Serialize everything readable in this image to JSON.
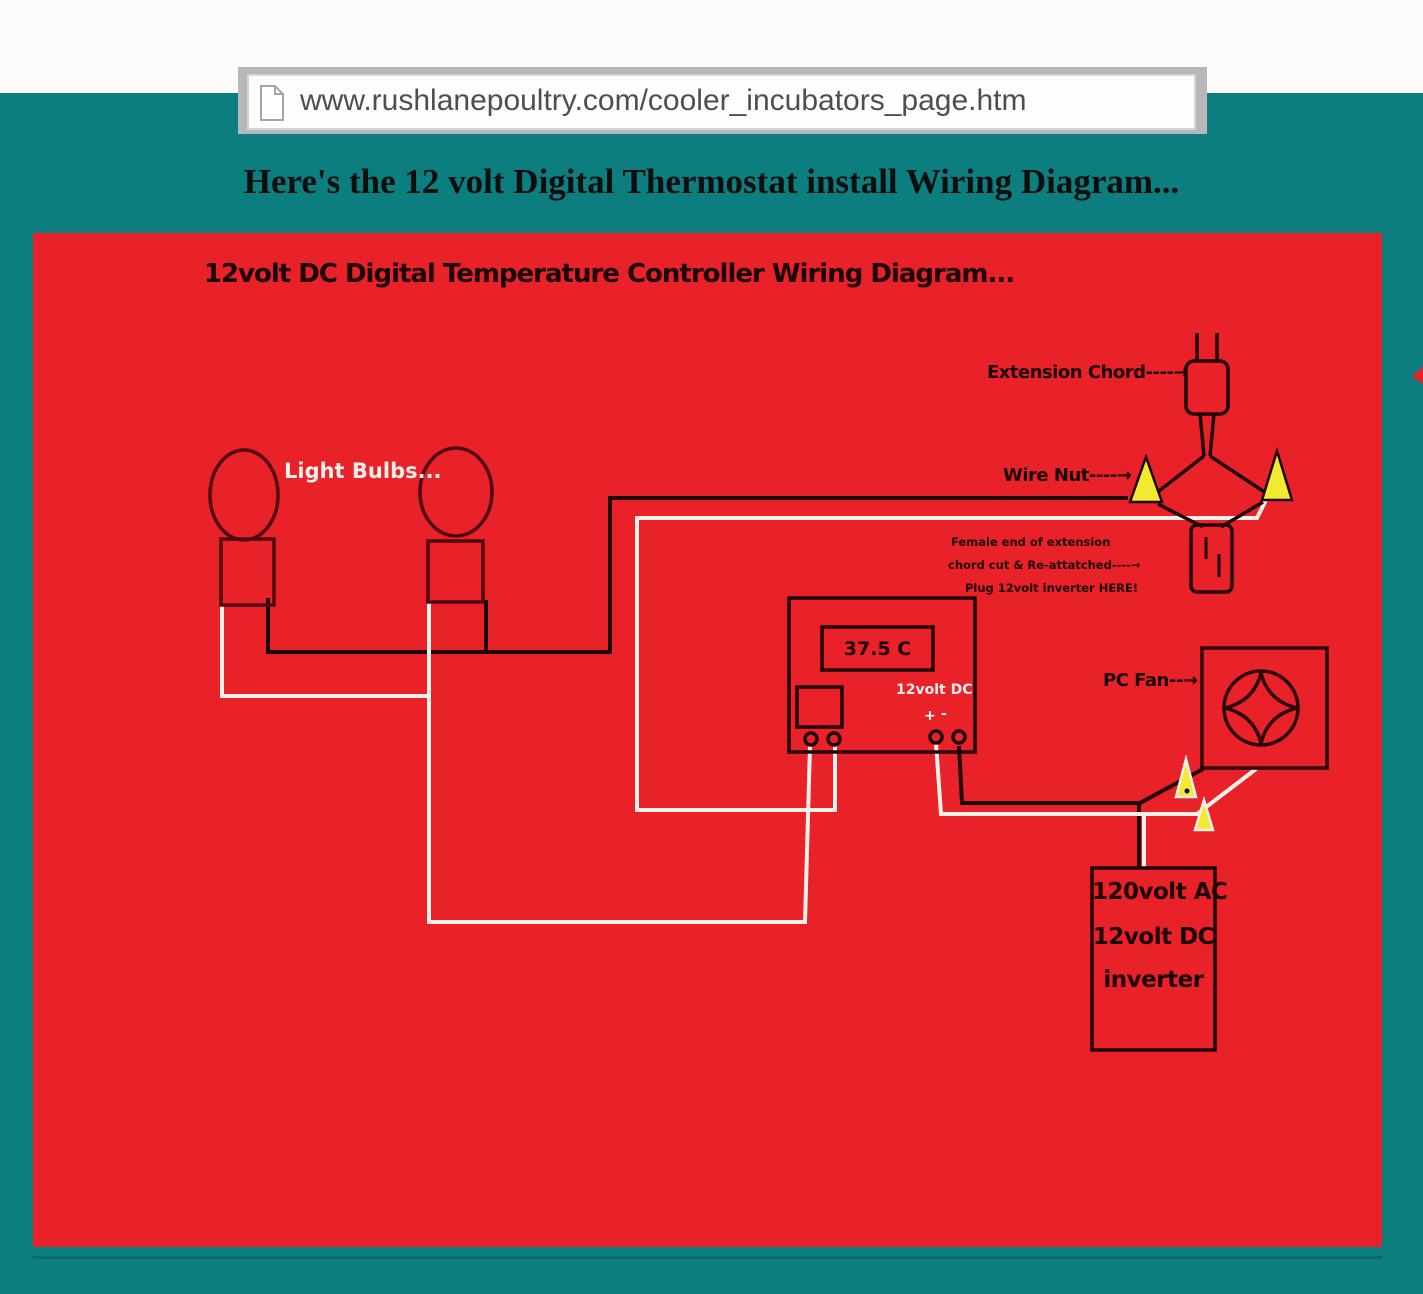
{
  "browser": {
    "url": "www.rushlanepoultry.com/cooler_incubators_page.htm"
  },
  "page": {
    "heading": "Here's the 12 volt Digital Thermostat install Wiring Diagram..."
  },
  "diagram": {
    "title": "12volt DC Digital Temperature Controller Wiring Diagram...",
    "labels": {
      "light_bulbs": "Light Bulbs...",
      "extension_chord": "Extension Chord----→",
      "wire_nut": "Wire Nut----→",
      "female_note_line1": "Female end of extension",
      "female_note_line2": "chord cut & Re-attatched----→",
      "female_note_line3": "Plug 12volt inverter  HERE!",
      "pc_fan": "PC Fan--→",
      "controller_display": "37.5 C",
      "controller_voltage": "12volt DC",
      "plus": "+",
      "minus": "-",
      "inverter_line1": "120volt AC",
      "inverter_line2": "12volt DC",
      "inverter_line3": "inverter"
    },
    "icons": {
      "document_icon": "document-icon",
      "fan_icon": "fan-blades-icon",
      "wire_nut_icon": "wire-nut-triangle"
    },
    "colors": {
      "panel_red": "#e92128",
      "page_teal": "#0d7e7f",
      "wire_black": "#1e0506",
      "wire_white": "#f7efe9",
      "wire_nut_yellow": "#f2ea2f",
      "bulb_outline": "#4e0a10"
    }
  }
}
